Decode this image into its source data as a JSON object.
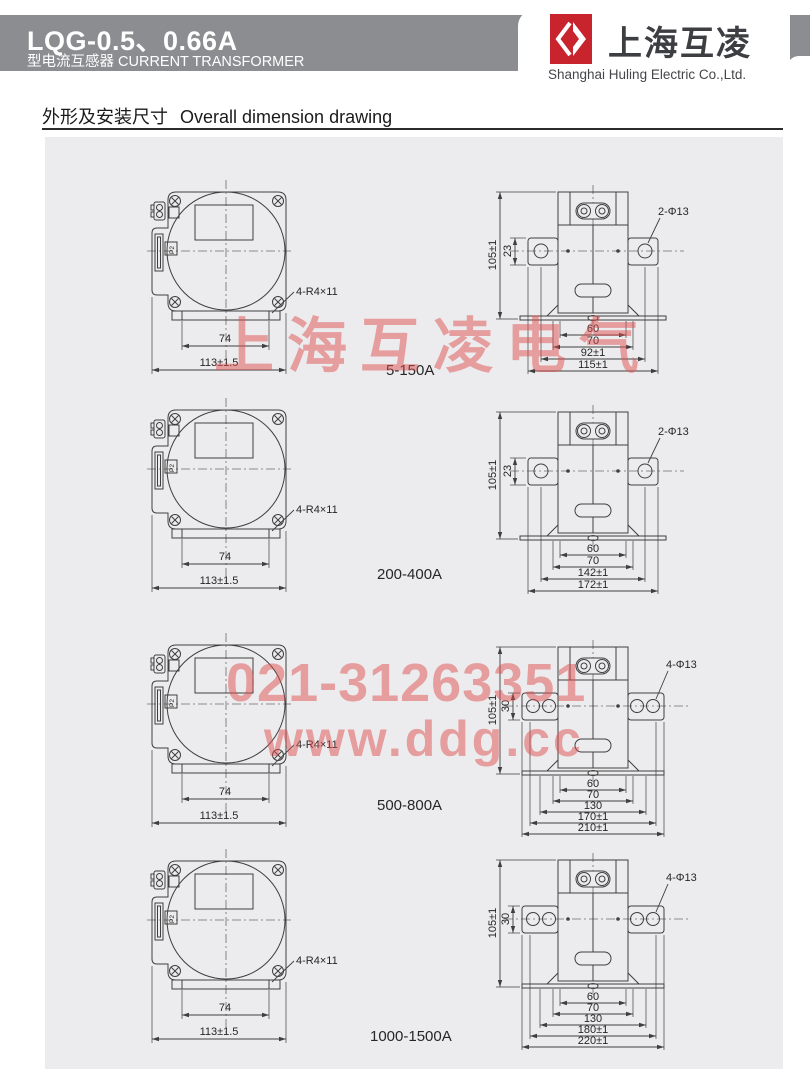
{
  "header": {
    "model": "LQG-0.5、0.66A",
    "type_line": "型电流互感器 CURRENT TRANSFORMER",
    "logo_text": "上海互凌",
    "company_en": "Shanghai Huling Electric Co.,Ltd."
  },
  "section": {
    "title_cn": "外形及安装尺寸",
    "title_en": "Overall dimension drawing"
  },
  "watermark": {
    "brand": "上海互凌电气",
    "phone": "021-31263351",
    "website": "www.ddg.cc"
  },
  "drawing": {
    "p2": "P2"
  },
  "rows": [
    {
      "label": "5-150A",
      "front": {
        "dim_inner": "74",
        "dim_outer": "113±1.5",
        "note": "4-R4×11"
      },
      "side": {
        "height": "105±1",
        "wing": "23",
        "hole_note": "2-Φ13",
        "bottom_dims": [
          "60",
          "70",
          "92±1",
          "115±1"
        ]
      }
    },
    {
      "label": "200-400A",
      "front": {
        "dim_inner": "74",
        "dim_outer": "113±1.5",
        "note": "4-R4×11"
      },
      "side": {
        "height": "105±1",
        "wing": "23",
        "hole_note": "2-Φ13",
        "bottom_dims": [
          "60",
          "70",
          "142±1",
          "172±1"
        ]
      }
    },
    {
      "label": "500-800A",
      "front": {
        "dim_inner": "74",
        "dim_outer": "113±1.5",
        "note": "4-R4×11"
      },
      "side": {
        "height": "105±1",
        "wing": "30",
        "hole_note": "4-Φ13",
        "bottom_dims": [
          "60",
          "70",
          "130",
          "170±1",
          "210±1"
        ]
      }
    },
    {
      "label": "1000-1500A",
      "front": {
        "dim_inner": "74",
        "dim_outer": "113±1.5",
        "note": "4-R4×11"
      },
      "side": {
        "height": "105±1",
        "wing": "30",
        "hole_note": "4-Φ13",
        "bottom_dims": [
          "60",
          "70",
          "130",
          "180±1",
          "220±1"
        ]
      }
    }
  ],
  "colors": {
    "banner_gray": "#8b8d90",
    "panel_gray": "#ececee",
    "logo_red": "#c8242d",
    "watermark_red": "#de4d4d",
    "line": "#3f3f3f"
  }
}
